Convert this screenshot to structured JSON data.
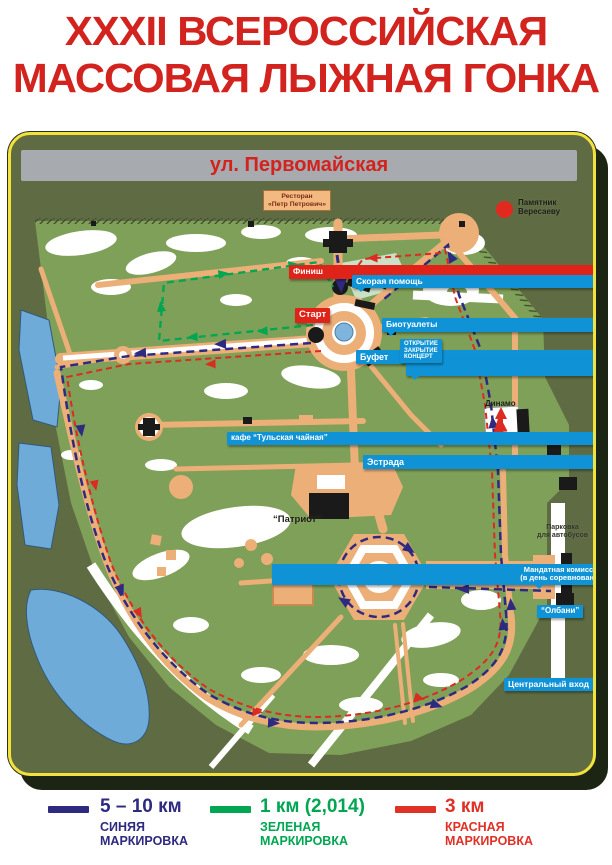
{
  "title": {
    "line1": "XXXII ВСЕРОССИЙСКАЯ",
    "line2": "МАССОВАЯ ЛЫЖНАЯ ГОНКА"
  },
  "map": {
    "street": "ул. Первомайская",
    "labels": {
      "restaurant_line1": "Ресторан",
      "restaurant_line2": "«Петр Петрович»",
      "monument_line1": "Памятник",
      "monument_line2": "Вересаеву",
      "finish": "Финиш",
      "ambulance": "Скорая помощь",
      "biotoilets": "Биотуалеты",
      "start": "Старт",
      "buffet": "Буфет",
      "field_kitchen_line1": "ПОЛЕВАЯ",
      "field_kitchen_line2": "КУХНЯ",
      "opening_line1": "ОТКРЫТИЕ",
      "opening_line2": "ЗАКРЫТИЕ",
      "opening_line3": "КОНЦЕРТ",
      "cafe": "кафе “Тульская чайная”",
      "stage": "Эстрада",
      "dynamo": "Динамо",
      "mandate_line1": "Мандатная комиссия",
      "mandate_line2": "(в день соревнований)",
      "patriot": "“Патриот”",
      "parking_line1": "Парковка",
      "parking_line2": "для автобусов",
      "central_entrance": "Центральный вход",
      "albany": "“Олбани”"
    }
  },
  "legend": {
    "items": [
      {
        "distance": "5 – 10 км",
        "marking_line1": "СИНЯЯ",
        "marking_line2": "МАРКИРОВКА",
        "color": "#2e2a80"
      },
      {
        "distance": "1 км (2,014)",
        "marking_line1": "ЗЕЛЕНАЯ",
        "marking_line2": "МАРКИРОВКА",
        "color": "#00a651"
      },
      {
        "distance": "3 км",
        "marking_line1": "КРАСНАЯ",
        "marking_line2": "МАРКИРОВКА",
        "color": "#e03127"
      }
    ]
  },
  "colors": {
    "title_red": "#d2231e",
    "panel_olive": "#5f6c43",
    "park_green": "#7fa058",
    "path_tan": "#ecaf78",
    "water_blue": "#6fabd9",
    "border_yellow": "#f2e23b",
    "street_bar_gray": "#a7aaaf",
    "badge_blue": "#0f93d6",
    "badge_red": "#e02318",
    "route_blue": "#2e2a80",
    "route_green": "#00a651",
    "route_red": "#dc2b20"
  }
}
